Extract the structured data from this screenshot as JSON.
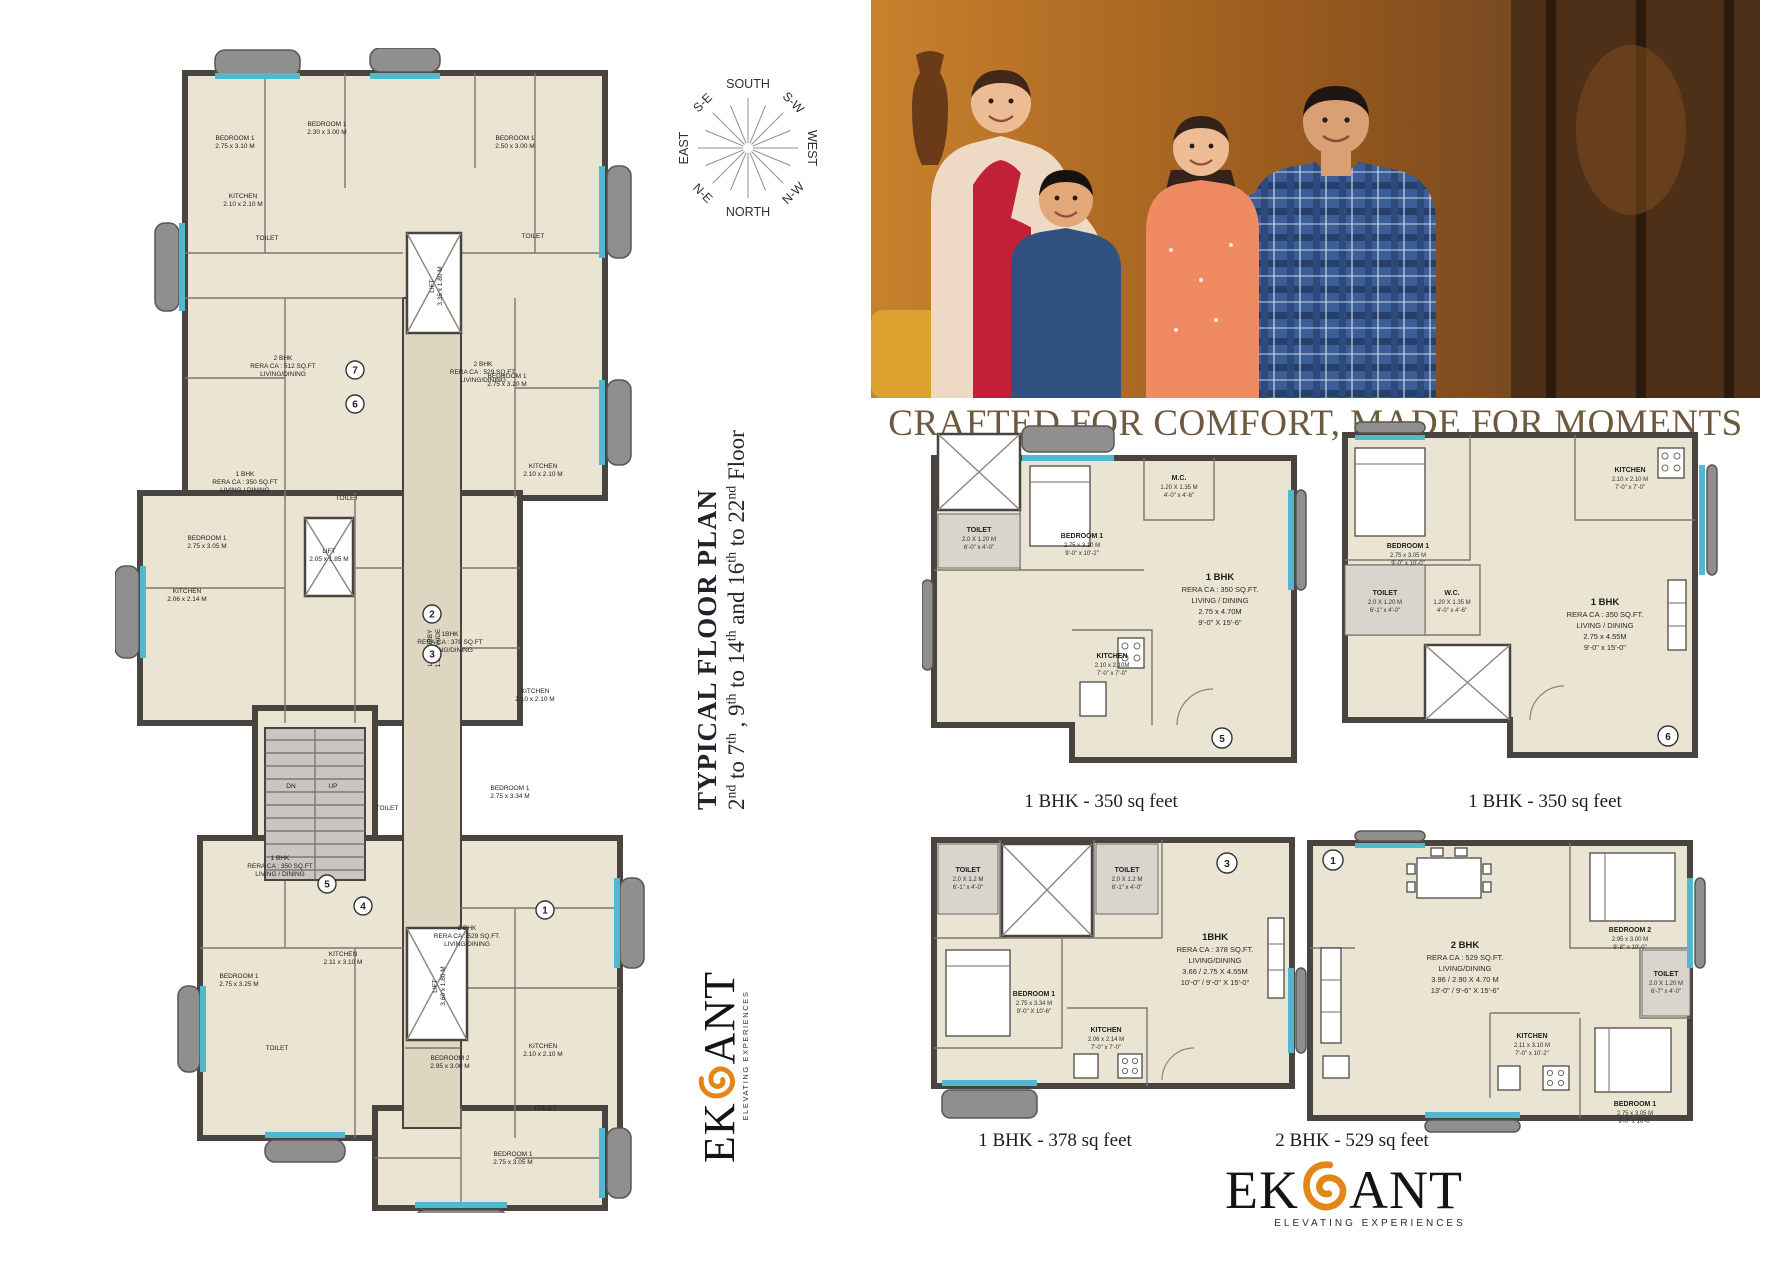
{
  "colors": {
    "accent_orange": "#e2861a",
    "heading_brown": "#6d5940",
    "wall": "#4a4440",
    "floor": "#eae4d2",
    "glass": "#4fb9cf",
    "balcony": "#8f8f8f"
  },
  "hero": {
    "heading": "CRAFTED FOR COMFORT, MADE FOR MOMENTS"
  },
  "floor_title": {
    "title": "TYPICAL FLOOR PLAN",
    "subtitle_segments": [
      {
        "t": "2"
      },
      {
        "t": "nd",
        "sup": true
      },
      {
        "t": " to 7"
      },
      {
        "t": "th",
        "sup": true
      },
      {
        "t": " , 9"
      },
      {
        "t": "th",
        "sup": true
      },
      {
        "t": " to 14"
      },
      {
        "t": "th",
        "sup": true
      },
      {
        "t": " and 16"
      },
      {
        "t": "th",
        "sup": true
      },
      {
        "t": " to 22"
      },
      {
        "t": "nd",
        "sup": true
      },
      {
        "t": " Floor"
      }
    ]
  },
  "compass": {
    "labels": [
      "SOUTH",
      "S-W",
      "WEST",
      "N-W",
      "NORTH",
      "N-E",
      "EAST",
      "S-E"
    ]
  },
  "logo": {
    "brand_pre": "EK",
    "brand_post": "ANT",
    "tagline": "ELEVATING EXPERIENCES"
  },
  "main_plan": {
    "labels": [
      {
        "lines": [
          "2 BHK",
          "RERA CA : 512 SQ.FT",
          "LIVING/DINING"
        ],
        "x": 168,
        "y": 312
      },
      {
        "lines": [
          "2 BHK",
          "RERA CA : 529 SQ.FT.",
          "LIVING/DINING"
        ],
        "x": 368,
        "y": 318
      },
      {
        "lines": [
          "1 BHK",
          "RERA CA : 350 SQ.FT",
          "LIVING / DINING"
        ],
        "x": 130,
        "y": 428
      },
      {
        "lines": [
          "1BHK",
          "RERA CA : 378 SQ.FT",
          "LIVING/DINING"
        ],
        "x": 335,
        "y": 588
      },
      {
        "lines": [
          "2 BHK",
          "RERA CA : 529 SQ.FT.",
          "LIVING/DINING"
        ],
        "x": 352,
        "y": 882
      },
      {
        "lines": [
          "1 BHK",
          "RERA CA : 350 SQ.FT",
          "LIVING / DINING"
        ],
        "x": 165,
        "y": 812
      },
      {
        "lines": [
          "LIFT LOBBY",
          "1.50 M WIDE"
        ],
        "x": 317,
        "y": 600,
        "rot": -90
      },
      {
        "lines": [
          "LIFT",
          "3.35 x 1.80 M"
        ],
        "x": 319,
        "y": 238,
        "rot": -90
      },
      {
        "lines": [
          "LIFT",
          "2.05 x 1.85 M"
        ],
        "x": 214,
        "y": 505
      },
      {
        "lines": [
          "LIFT",
          "3.60 x 1.80 M"
        ],
        "x": 322,
        "y": 938,
        "rot": -90
      },
      {
        "lines": [
          "KITCHEN",
          "2.10 x 2.10 M"
        ],
        "x": 128,
        "y": 150
      },
      {
        "lines": [
          "KITCHEN",
          "2.10 x 2.10 M"
        ],
        "x": 428,
        "y": 420
      },
      {
        "lines": [
          "KITCHEN",
          "2.06 x 2.14 M"
        ],
        "x": 72,
        "y": 545
      },
      {
        "lines": [
          "KITCHEN",
          "2.10 x 2.10 M"
        ],
        "x": 420,
        "y": 645
      },
      {
        "lines": [
          "KITCHEN",
          "2.11 x 3.10 M"
        ],
        "x": 228,
        "y": 908
      },
      {
        "lines": [
          "KITCHEN",
          "2.10 x 2.10 M"
        ],
        "x": 428,
        "y": 1000
      },
      {
        "lines": [
          "BEDROOM 1",
          "2.75 x 3.10 M"
        ],
        "x": 120,
        "y": 92
      },
      {
        "lines": [
          "BEDROOM 1",
          "2.30 x 3.00 M"
        ],
        "x": 212,
        "y": 78
      },
      {
        "lines": [
          "BEDROOM 1",
          "2.50 x 3.00 M"
        ],
        "x": 400,
        "y": 92
      },
      {
        "lines": [
          "BEDROOM 1",
          "2.75 x 3.20 M"
        ],
        "x": 392,
        "y": 330
      },
      {
        "lines": [
          "BEDROOM 1",
          "2.75 x 3.05 M"
        ],
        "x": 92,
        "y": 492
      },
      {
        "lines": [
          "BEDROOM 1",
          "2.75 x 3.34 M"
        ],
        "x": 395,
        "y": 742
      },
      {
        "lines": [
          "BEDROOM 1",
          "2.75 x 3.25 M"
        ],
        "x": 124,
        "y": 930
      },
      {
        "lines": [
          "BEDROOM 2",
          "2.95 x 3.00 M"
        ],
        "x": 335,
        "y": 1012
      },
      {
        "lines": [
          "BEDROOM 1",
          "2.75 x 3.05 M"
        ],
        "x": 398,
        "y": 1108
      },
      {
        "lines": [
          "TOILET"
        ],
        "x": 152,
        "y": 192
      },
      {
        "lines": [
          "TOILET"
        ],
        "x": 418,
        "y": 190
      },
      {
        "lines": [
          "TOILET"
        ],
        "x": 232,
        "y": 452
      },
      {
        "lines": [
          "TOILET"
        ],
        "x": 272,
        "y": 762
      },
      {
        "lines": [
          "TOILET"
        ],
        "x": 162,
        "y": 1002
      },
      {
        "lines": [
          "TOILET"
        ],
        "x": 430,
        "y": 1062
      },
      {
        "lines": [
          "UP"
        ],
        "x": 218,
        "y": 740
      },
      {
        "lines": [
          "DN"
        ],
        "x": 176,
        "y": 740
      }
    ],
    "unit_numbers": [
      {
        "n": "7",
        "x": 240,
        "y": 322
      },
      {
        "n": "6",
        "x": 240,
        "y": 356
      },
      {
        "n": "5",
        "x": 212,
        "y": 836
      },
      {
        "n": "4",
        "x": 248,
        "y": 858
      },
      {
        "n": "3",
        "x": 317,
        "y": 606
      },
      {
        "n": "2",
        "x": 317,
        "y": 566
      },
      {
        "n": "1",
        "x": 430,
        "y": 862
      }
    ]
  },
  "units": {
    "u5": {
      "number": "5",
      "caption": "1 BHK - 350 sq feet",
      "center": [
        "1 BHK",
        "RERA CA : 350 SQ.FT.",
        "LIVING / DINING",
        "2.75 x 4.70M",
        "9'-0\" X 15'-6\""
      ],
      "bedroom": [
        "BEDROOM 1",
        "2.75 x 3.10 M",
        "9'-0\" x 10'-2\""
      ],
      "kitchen": [
        "KITCHEN",
        "2.10 x 2.10M",
        "7'-0\" x 7'-0\""
      ],
      "toilet": [
        "TOILET",
        "2.0 X 1.20 M",
        "6'-0\" x 4'-0\""
      ],
      "extra": [
        "M.C.",
        "1.20 X 1.35 M",
        "4'-0\" x 4'-6\""
      ]
    },
    "u6": {
      "number": "6",
      "caption": "1 BHK - 350 sq feet",
      "center": [
        "1 BHK",
        "RERA CA : 350 SQ.FT.",
        "LIVING / DINING",
        "2.75 x 4.55M",
        "9'-0\" x 15'-0\""
      ],
      "bedroom": [
        "BEDROOM 1",
        "2.75 x 3.05 M",
        "9'-0\" x 10'-0\""
      ],
      "kitchen": [
        "KITCHEN",
        "2.10 x 2.10 M",
        "7'-0\" x 7'-0\""
      ],
      "toilet": [
        "TOILET",
        "2.0 X 1.20 M",
        "6'-1\" x 4'-0\""
      ],
      "extra": [
        "W.C.",
        "1.20 X 1.35 M",
        "4'-0\" x 4'-6\""
      ]
    },
    "u3": {
      "number": "3",
      "caption": "1 BHK - 378 sq feet",
      "center": [
        "1BHK",
        "RERA CA : 378 SQ.FT.",
        "LIVING/DINING",
        "3.66 / 2.75 X 4.55M",
        "10'-0\" / 9'-0\" X 15'-0\""
      ],
      "bedroom": [
        "BEDROOM 1",
        "2.75 x 3.34 M",
        "9'-0\" X 10'-6\""
      ],
      "kitchen": [
        "KITCHEN",
        "2.06 x 2.14 M",
        "7'-0\" x 7'-0\""
      ],
      "toilet": [
        "TOILET",
        "2.0 X 1.2 M",
        "6'-1\" x 4'-0\""
      ],
      "toilet2": [
        "TOILET",
        "2.0 X 1.2 M",
        "6'-1\" x 4'-0\""
      ]
    },
    "u1": {
      "number": "1",
      "caption": "2 BHK - 529 sq feet",
      "center": [
        "2 BHK",
        "RERA CA : 529 SQ.FT.",
        "LIVING/DINING",
        "3.96 / 2.90 X 4.70 M",
        "13'-0\" / 9'-6\" X 15'-6\""
      ],
      "bedroom2": [
        "BEDROOM 2",
        "2.95 x 3.00 M",
        "9'-8\" x 10'-0\""
      ],
      "bedroom": [
        "BEDROOM 1",
        "2.75 x 3.05 M",
        "9'-0\" x 10'-0\""
      ],
      "kitchen": [
        "KITCHEN",
        "2.11 x 3.10 M",
        "7'-0\" x 10'-2\""
      ],
      "toilet": [
        "TOILET",
        "2.0 X 1.20 M",
        "6'-7\" x 4'-0\""
      ]
    }
  }
}
